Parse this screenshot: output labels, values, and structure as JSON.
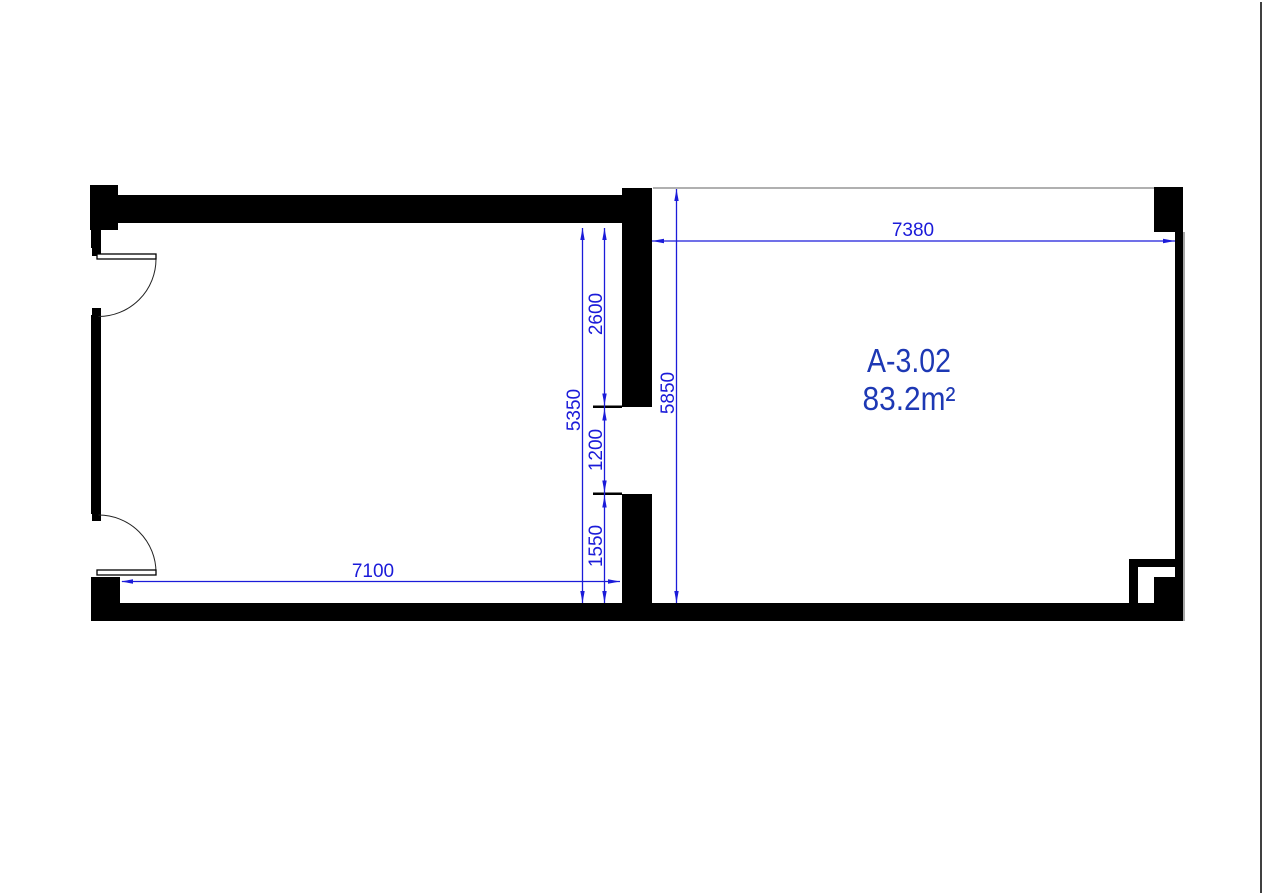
{
  "plan": {
    "unit": {
      "name": "A-3.02",
      "area": "83.2m²"
    },
    "dimensions": {
      "right_room_width": "7380",
      "right_room_height": "5850",
      "left_room_height": "5350",
      "partition_upper_wall": "2600",
      "partition_opening": "1200",
      "partition_lower_wall": "1550",
      "left_room_width": "7100"
    },
    "colors": {
      "wall": "#000000",
      "dimension_blue": "#1b1bd9",
      "label_blue": "#1d38b4",
      "boundary_gray": "#b0b0b0",
      "sheet_edge_gray": "#2b2b2b",
      "background": "#ffffff"
    }
  }
}
